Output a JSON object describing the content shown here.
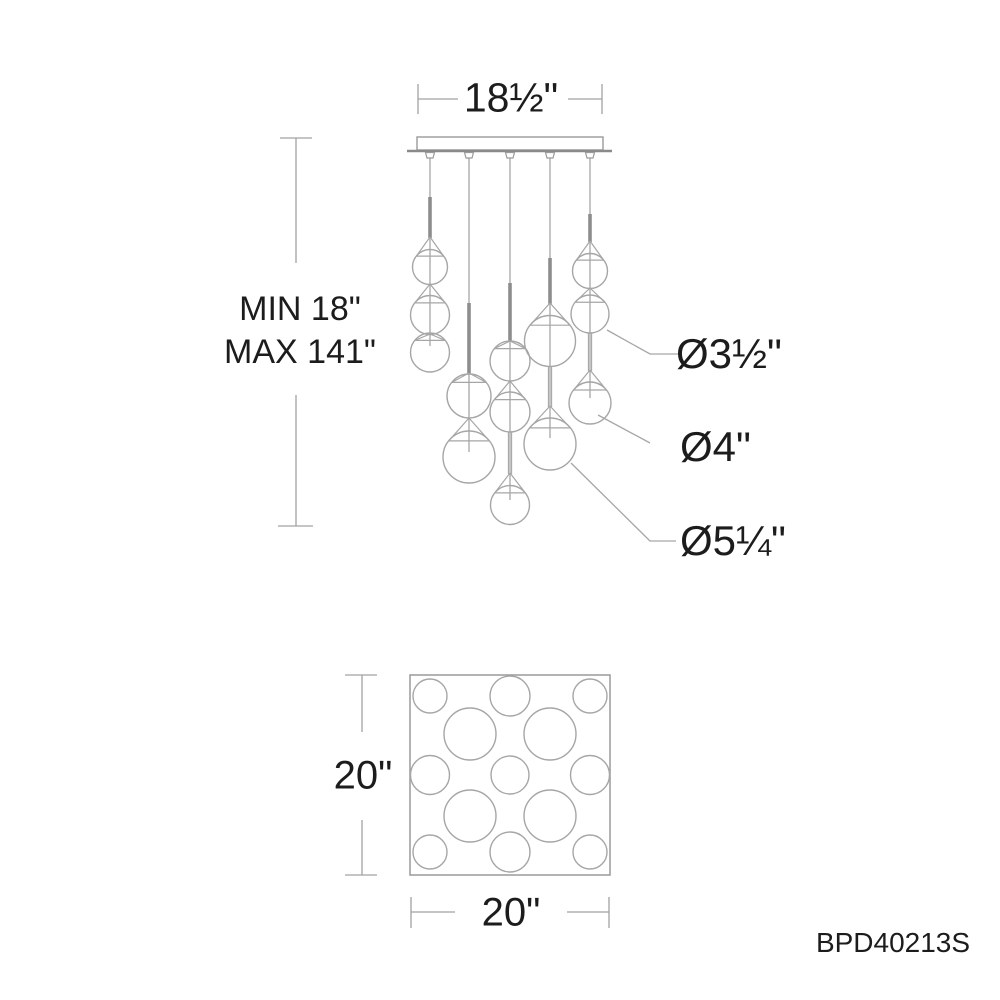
{
  "labels": {
    "canopy_width": "18½\"",
    "hang_min": "MIN 18\"",
    "hang_max": "MAX 141\"",
    "dia_small": "Ø3½\"",
    "dia_medium": "Ø4\"",
    "dia_large": "Ø5¼\"",
    "plan_height": "20\"",
    "plan_width": "20\"",
    "part_number": "BPD40213S"
  },
  "drawing": {
    "colors": {
      "line": "#a6a6a6",
      "thick": "#8d8d8d",
      "dim": "#a2a2a2",
      "edge": "#9a9a9a",
      "flange": "#8a8a8a"
    },
    "canopy": {
      "x": 417,
      "y": 137,
      "w": 186,
      "h": 13,
      "flange": [
        407,
        612,
        151
      ]
    },
    "nub_xs": [
      430,
      469,
      510,
      550,
      590
    ],
    "cords": [
      {
        "x": 430,
        "thin": [
          150,
          346
        ],
        "thick": [
          197,
          238
        ]
      },
      {
        "x": 469,
        "thin": [
          150,
          452
        ],
        "thick": [
          303,
          374
        ]
      },
      {
        "x": 510,
        "thin": [
          150,
          500
        ],
        "thick": [
          283,
          342
        ]
      },
      {
        "x": 550,
        "thin": [
          150,
          438
        ],
        "thick": [
          258,
          304
        ]
      },
      {
        "x": 590,
        "thin": [
          150,
          398
        ],
        "thick": [
          214,
          242
        ]
      }
    ],
    "stems": [
      {
        "x": 510,
        "y1": 432,
        "y2": 474
      },
      {
        "x": 550,
        "y1": 367,
        "y2": 407
      },
      {
        "x": 590,
        "y1": 333,
        "y2": 371
      }
    ],
    "globes": [
      {
        "cx": 430,
        "cy": 267,
        "r": 17.5,
        "apex": 237,
        "size": "3-half-in"
      },
      {
        "cx": 430,
        "cy": 315,
        "r": 19.5,
        "apex": 284,
        "size": "4-in"
      },
      {
        "cx": 430,
        "cy": 352.5,
        "r": 19.5,
        "apex": 334,
        "size": "4-in"
      },
      {
        "cx": 469,
        "cy": 396,
        "r": 22,
        "apex": 373,
        "size": "4-in"
      },
      {
        "cx": 469,
        "cy": 457,
        "r": 26,
        "apex": 418,
        "size": "5-quarter-in"
      },
      {
        "cx": 510,
        "cy": 361,
        "r": 20,
        "apex": 341,
        "size": "4-in"
      },
      {
        "cx": 510,
        "cy": 412,
        "r": 20,
        "apex": 381,
        "size": "4-in"
      },
      {
        "cx": 510,
        "cy": 505,
        "r": 19.5,
        "apex": 473,
        "size": "4-in"
      },
      {
        "cx": 550,
        "cy": 341,
        "r": 25.5,
        "apex": 303,
        "size": "5-quarter-in"
      },
      {
        "cx": 550,
        "cy": 444,
        "r": 26,
        "apex": 406,
        "size": "5-quarter-in"
      },
      {
        "cx": 590,
        "cy": 271,
        "r": 17.5,
        "apex": 241,
        "size": "3-half-in"
      },
      {
        "cx": 590,
        "cy": 314,
        "r": 19,
        "apex": 288,
        "size": "3-half-in"
      },
      {
        "cx": 590,
        "cy": 403,
        "r": 21,
        "apex": 370,
        "size": "4-in"
      }
    ],
    "leaders": [
      {
        "points": "607,330 650,354 681,354"
      },
      {
        "points": "598,415 650,443"
      },
      {
        "points": "571,463 650,541 676,541"
      }
    ],
    "dim_lines": [
      [
        418,
        84,
        418,
        114
      ],
      [
        602,
        84,
        602,
        114
      ],
      [
        418,
        99,
        458,
        99
      ],
      [
        568,
        99,
        602,
        99
      ],
      [
        280,
        138,
        312,
        138
      ],
      [
        296,
        138,
        296,
        263
      ],
      [
        296,
        395,
        296,
        526
      ],
      [
        278,
        526,
        313,
        526
      ],
      [
        345,
        675,
        377,
        675
      ],
      [
        362,
        675,
        362,
        732
      ],
      [
        362,
        820,
        362,
        875
      ],
      [
        345,
        875,
        377,
        875
      ],
      [
        411,
        897,
        411,
        928
      ],
      [
        411,
        912,
        455,
        912
      ],
      [
        567,
        912,
        609,
        912
      ],
      [
        609,
        897,
        609,
        928
      ]
    ],
    "plan": {
      "square": [
        410,
        675,
        200,
        200
      ],
      "circles": [
        [
          430,
          696,
          17
        ],
        [
          510,
          696,
          20
        ],
        [
          590,
          696,
          17
        ],
        [
          470,
          734,
          26
        ],
        [
          550,
          734,
          26
        ],
        [
          430,
          775,
          19.5
        ],
        [
          510,
          775,
          19
        ],
        [
          590,
          775,
          19.5
        ],
        [
          470,
          816,
          26
        ],
        [
          550,
          816,
          26
        ],
        [
          430,
          852,
          17
        ],
        [
          510,
          852,
          20
        ],
        [
          590,
          852,
          17
        ]
      ]
    }
  }
}
